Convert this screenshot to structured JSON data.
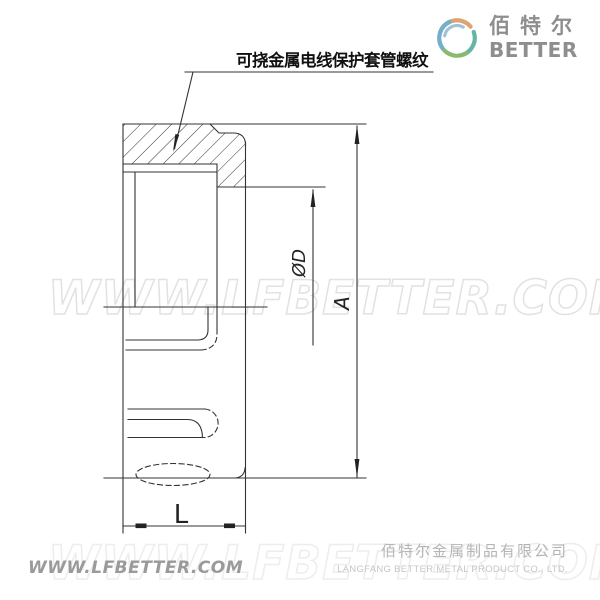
{
  "annotation": {
    "label": "可挠金属电线保护套管螺纹"
  },
  "dimensions": {
    "height": "A",
    "diameter": "ØD",
    "length": "L"
  },
  "watermark": {
    "text": "WWW.LFBETTER.COM"
  },
  "logo": {
    "name_cn": "佰特尔",
    "name_en": "BETTER"
  },
  "footer": {
    "website": "WWW.LFBETTER.COM",
    "company_cn": "佰特尔金属制品有限公司",
    "company_en": "LANGFANG BETTER METAL PRODUCT CO., LTD."
  },
  "colors": {
    "drawing_line": "#333333",
    "watermark_stroke": "#e2e2e2",
    "logo_text": "#8e8e8e",
    "logo_orange": "#dfa271",
    "logo_blue": "#74aecb",
    "logo_inner_blue": "#9cc3d8",
    "logo_teal": "#66b5a3",
    "logo_green": "#8cba6c",
    "footer_text": "#9a9a9a"
  }
}
